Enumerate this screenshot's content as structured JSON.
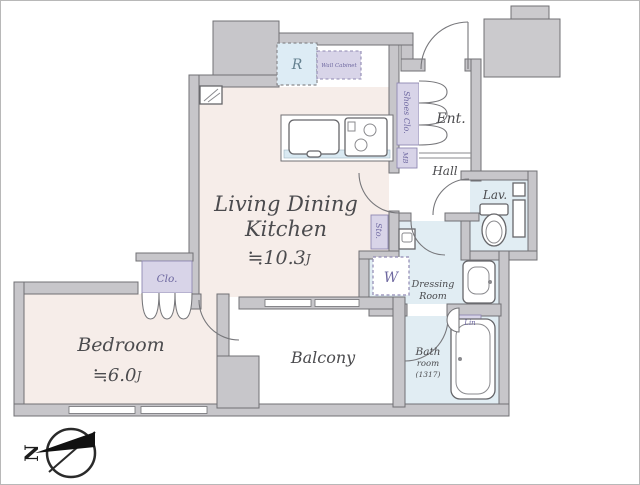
{
  "plan": {
    "rooms": {
      "ldk": {
        "line1": "Living Dining",
        "line2": "Kitchen",
        "area": "≒10.3",
        "unit": "J"
      },
      "bedroom": {
        "label": "Bedroom",
        "area": "≒6.0",
        "unit": "J"
      },
      "balcony": {
        "label": "Balcony"
      },
      "entrance": {
        "label": "Ent."
      },
      "hall": {
        "label": "Hall"
      },
      "lavatory": {
        "label": "Lav."
      },
      "dressing_room": {
        "line1": "Dressing",
        "line2": "Room"
      },
      "bathroom": {
        "line1": "Bath",
        "line2": "room",
        "line3": "(1317)"
      }
    },
    "storage_labels": {
      "closet": "Clo.",
      "shoes_closet": "Shoes Clo.",
      "storage": "Sto.",
      "linen": "Lin",
      "meter_box": "MB",
      "wall_cabinet": "Wall Cabinet"
    },
    "appliance_labels": {
      "refrigerator": "R",
      "washing_machine": "W"
    },
    "compass": {
      "north": "N"
    },
    "colors": {
      "floor": "#f6ede9",
      "wet_area": "#e1edf3",
      "closet_fill": "#d8d4e8",
      "wall_fill": "#c7c6ca",
      "wall_stroke": "#707074",
      "label_purple": "#6e68a0",
      "label_blue": "#64808f",
      "text_dark": "#4b4b4e"
    }
  }
}
